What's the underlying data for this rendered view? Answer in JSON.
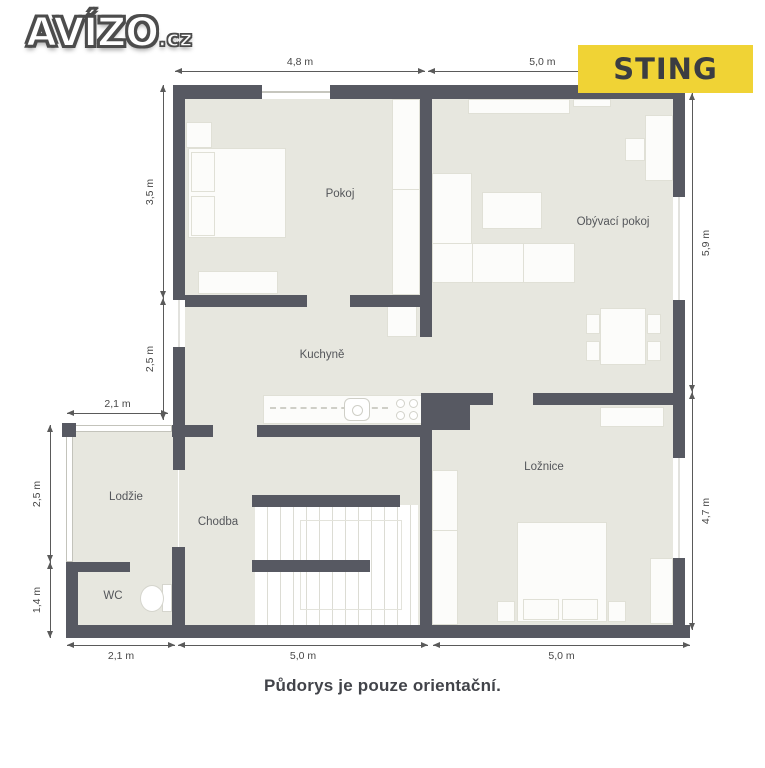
{
  "header": {
    "logo": {
      "main": "AVÍZO",
      "suffix": ".cz"
    },
    "brand": {
      "label": "STING",
      "bg_color": "#f0d335",
      "fg_color": "#3b3d42"
    }
  },
  "plan": {
    "rooms": [
      {
        "id": "pokoj",
        "label": "Pokoj"
      },
      {
        "id": "obyvaci-pokoj",
        "label": "Obývací pokoj"
      },
      {
        "id": "kuchyne",
        "label": "Kuchyně"
      },
      {
        "id": "loznice",
        "label": "Ložnice"
      },
      {
        "id": "lodzie",
        "label": "Lodžie"
      },
      {
        "id": "chodba",
        "label": "Chodba"
      },
      {
        "id": "wc",
        "label": "WC"
      }
    ],
    "dimensions": {
      "top": [
        "4,8 m",
        "5,0 m"
      ],
      "left_inner": [
        "3,5 m",
        "2,5 m"
      ],
      "lodzie_top": "2,1 m",
      "left_outer": [
        "2,5 m",
        "1,4 m"
      ],
      "right": [
        "5,9 m",
        "4,7 m"
      ],
      "bottom": [
        "2,1 m",
        "5,0 m",
        "5,0 m"
      ]
    },
    "colors": {
      "wall": "#575962",
      "floor": "#e7e7df",
      "furniture": "#fcfcfa"
    }
  },
  "footer": {
    "note": "Půdorys je pouze orientační."
  }
}
